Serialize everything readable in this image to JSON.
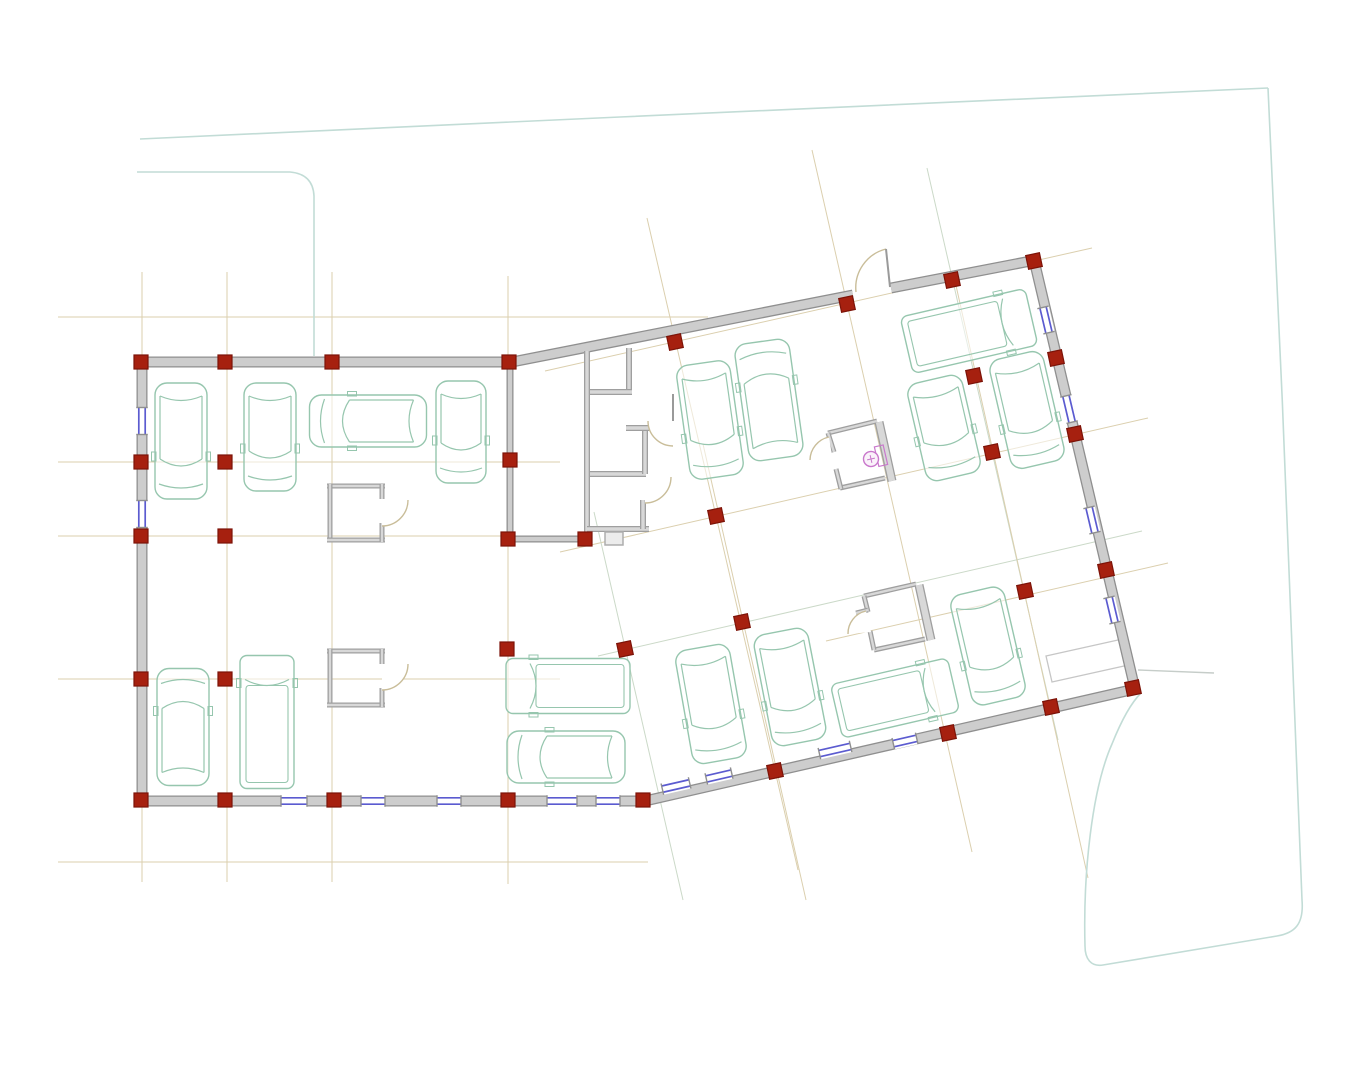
{
  "canvas": {
    "width": 1365,
    "height": 1080,
    "background": "#ffffff"
  },
  "palette": {
    "wall_edge": "#8f8f8f",
    "wall_fill": "#cdcdcd",
    "thin_edge": "#9f9f9f",
    "thin_fill": "#d8d8d8",
    "column_fill": "#a6200f",
    "column_edge": "#7c1308",
    "window_glass": "#5b5bd0",
    "car_outline": "#96c6ae",
    "door_arc": "#c9bd99",
    "leaf_gray": "#9a9a9a",
    "grid_tan": "#dbcfae",
    "grid_sage": "#cbd9c8",
    "site_teal": "#c2dcd6",
    "site_gray": "#c6cdc9",
    "toilet_pink": "#c978cc",
    "misc_gray": "#c6c6c6",
    "tab_edge": "#adadad",
    "tab_fill": "#ececec"
  },
  "grid": {
    "ortho": [
      {
        "x1": 142,
        "y1": 272,
        "x2": 142,
        "y2": 882,
        "c": "t"
      },
      {
        "x1": 227,
        "y1": 272,
        "x2": 227,
        "y2": 882,
        "c": "t"
      },
      {
        "x1": 332,
        "y1": 272,
        "x2": 332,
        "y2": 882,
        "c": "t"
      },
      {
        "x1": 508,
        "y1": 276,
        "x2": 508,
        "y2": 884,
        "c": "t"
      },
      {
        "x1": 58,
        "y1": 317,
        "x2": 708,
        "y2": 317,
        "c": "t"
      },
      {
        "x1": 58,
        "y1": 462,
        "x2": 560,
        "y2": 462,
        "c": "t"
      },
      {
        "x1": 58,
        "y1": 536,
        "x2": 560,
        "y2": 536,
        "c": "t"
      },
      {
        "x1": 58,
        "y1": 679,
        "x2": 560,
        "y2": 679,
        "c": "t"
      },
      {
        "x1": 58,
        "y1": 862,
        "x2": 648,
        "y2": 862,
        "c": "t"
      }
    ],
    "tilted": [
      {
        "x1": 545,
        "y1": 371,
        "x2": 1092,
        "y2": 248,
        "c": "t"
      },
      {
        "x1": 560,
        "y1": 552,
        "x2": 1148,
        "y2": 418,
        "c": "t"
      },
      {
        "x1": 598,
        "y1": 656,
        "x2": 1142,
        "y2": 531,
        "c": "s"
      },
      {
        "x1": 826,
        "y1": 641,
        "x2": 1168,
        "y2": 563,
        "c": "t"
      },
      {
        "x1": 647,
        "y1": 218,
        "x2": 798,
        "y2": 870,
        "c": "t"
      },
      {
        "x1": 812,
        "y1": 150,
        "x2": 972,
        "y2": 852,
        "c": "t"
      },
      {
        "x1": 927,
        "y1": 168,
        "x2": 1058,
        "y2": 740,
        "c": "s"
      },
      {
        "x1": 594,
        "y1": 512,
        "x2": 683,
        "y2": 900,
        "c": "s"
      },
      {
        "x1": 703,
        "y1": 444,
        "x2": 806,
        "y2": 900,
        "c": "t"
      },
      {
        "x1": 953,
        "y1": 272,
        "x2": 1088,
        "y2": 878,
        "c": "t"
      }
    ]
  },
  "site": {
    "teal_paths": [
      "M 140 139 L 620 117 L 1268 88",
      "M 137 172 L 290 172 Q 313 174 314 196 L 314 356",
      "M 1268 88 C 1281 350 1295 705 1302 900 C 1304 924 1295 933 1277 936 L 1103 965 C 1091 967 1085 959 1085 946 C 1083 873 1092 789 1112 744 C 1122 719 1132 702 1141 693"
    ],
    "gray_line": "M 1138 670 L 1214 673",
    "pad_quad": "M 1046 656 L 1127 638 L 1133 664 L 1052 682 Z"
  },
  "walls": {
    "outer": [
      {
        "x1": 137,
        "y1": 362,
        "x2": 512,
        "y2": 362,
        "w": 11
      },
      {
        "x1": 512,
        "y1": 362,
        "x2": 853,
        "y2": 295,
        "w": 11
      },
      {
        "x1": 891,
        "y1": 288,
        "x2": 1036,
        "y2": 260,
        "w": 11
      },
      {
        "x1": 1034,
        "y1": 260,
        "x2": 1135,
        "y2": 689,
        "w": 11
      },
      {
        "x1": 1135,
        "y1": 689,
        "x2": 645,
        "y2": 801,
        "w": 11
      },
      {
        "x1": 645,
        "y1": 801,
        "x2": 137,
        "y2": 801,
        "w": 11
      },
      {
        "x1": 142,
        "y1": 362,
        "x2": 142,
        "y2": 801,
        "w": 11
      }
    ],
    "interior": [
      {
        "x1": 510,
        "y1": 357,
        "x2": 510,
        "y2": 543,
        "w": 7
      },
      {
        "x1": 513,
        "y1": 539,
        "x2": 592,
        "y2": 539,
        "w": 7
      }
    ],
    "core": [
      {
        "x1": 587,
        "y1": 351,
        "x2": 587,
        "y2": 532,
        "w": 6
      },
      {
        "x1": 587,
        "y1": 529,
        "x2": 649,
        "y2": 529,
        "w": 6
      },
      {
        "x1": 629,
        "y1": 348,
        "x2": 629,
        "y2": 392,
        "w": 6
      },
      {
        "x1": 590,
        "y1": 392,
        "x2": 632,
        "y2": 392,
        "w": 6
      },
      {
        "x1": 590,
        "y1": 474,
        "x2": 646,
        "y2": 474,
        "w": 6
      },
      {
        "x1": 645,
        "y1": 429,
        "x2": 645,
        "y2": 474,
        "w": 6
      },
      {
        "x1": 626,
        "y1": 428,
        "x2": 654,
        "y2": 428,
        "w": 6
      },
      {
        "x1": 643,
        "y1": 500,
        "x2": 643,
        "y2": 529,
        "w": 6
      }
    ],
    "rooms": [
      {
        "x1": 327,
        "y1": 486,
        "x2": 385,
        "y2": 486,
        "w": 5
      },
      {
        "x1": 330,
        "y1": 484,
        "x2": 330,
        "y2": 542,
        "w": 5
      },
      {
        "x1": 327,
        "y1": 540,
        "x2": 385,
        "y2": 540,
        "w": 5
      },
      {
        "x1": 382,
        "y1": 484,
        "x2": 382,
        "y2": 499,
        "w": 5
      },
      {
        "x1": 382,
        "y1": 523,
        "x2": 382,
        "y2": 542,
        "w": 5
      },
      {
        "x1": 327,
        "y1": 651,
        "x2": 385,
        "y2": 651,
        "w": 5
      },
      {
        "x1": 330,
        "y1": 649,
        "x2": 330,
        "y2": 707,
        "w": 5
      },
      {
        "x1": 327,
        "y1": 705,
        "x2": 385,
        "y2": 705,
        "w": 5
      },
      {
        "x1": 382,
        "y1": 649,
        "x2": 382,
        "y2": 664,
        "w": 5
      },
      {
        "x1": 382,
        "y1": 688,
        "x2": 382,
        "y2": 707,
        "w": 5
      },
      {
        "x1": 828,
        "y1": 433,
        "x2": 877,
        "y2": 421,
        "w": 5
      },
      {
        "x1": 840,
        "y1": 488,
        "x2": 885,
        "y2": 478,
        "w": 5
      },
      {
        "x1": 828,
        "y1": 433,
        "x2": 834,
        "y2": 452,
        "w": 5
      },
      {
        "x1": 836,
        "y1": 469,
        "x2": 841,
        "y2": 489,
        "w": 5
      },
      {
        "x1": 879,
        "y1": 422,
        "x2": 892,
        "y2": 481,
        "w": 9
      },
      {
        "x1": 864,
        "y1": 596,
        "x2": 916,
        "y2": 584,
        "w": 5
      },
      {
        "x1": 874,
        "y1": 650,
        "x2": 925,
        "y2": 639,
        "w": 5
      },
      {
        "x1": 864,
        "y1": 596,
        "x2": 868,
        "y2": 612,
        "w": 5
      },
      {
        "x1": 856,
        "y1": 613,
        "x2": 868,
        "y2": 610,
        "w": 5
      },
      {
        "x1": 870,
        "y1": 631,
        "x2": 874,
        "y2": 650,
        "w": 5
      },
      {
        "x1": 919,
        "y1": 585,
        "x2": 931,
        "y2": 640,
        "w": 9
      }
    ]
  },
  "windows": [
    {
      "x": 142,
      "y": 421,
      "a": 90,
      "len": 27
    },
    {
      "x": 142,
      "y": 514,
      "a": 90,
      "len": 27
    },
    {
      "x": 294,
      "y": 801,
      "a": 0,
      "len": 26
    },
    {
      "x": 373,
      "y": 801,
      "a": 0,
      "len": 24
    },
    {
      "x": 449,
      "y": 801,
      "a": 0,
      "len": 24
    },
    {
      "x": 562,
      "y": 801,
      "a": 0,
      "len": 30
    },
    {
      "x": 608,
      "y": 801,
      "a": 0,
      "len": 24
    },
    {
      "x": 676,
      "y": 786,
      "a": -12.9,
      "len": 28
    },
    {
      "x": 719,
      "y": 776,
      "a": -12.9,
      "len": 26
    },
    {
      "x": 835,
      "y": 750,
      "a": -12.9,
      "len": 32
    },
    {
      "x": 905,
      "y": 741,
      "a": -12.9,
      "len": 24
    },
    {
      "x": 1046,
      "y": 320,
      "a": 76.7,
      "len": 26
    },
    {
      "x": 1069,
      "y": 409,
      "a": 76.7,
      "len": 27
    },
    {
      "x": 1092,
      "y": 520,
      "a": 76.7,
      "len": 26
    },
    {
      "x": 1112,
      "y": 610,
      "a": 76.7,
      "len": 26
    }
  ],
  "columns": [
    {
      "x": 141,
      "y": 362,
      "a": 0
    },
    {
      "x": 225,
      "y": 362,
      "a": 0
    },
    {
      "x": 332,
      "y": 362,
      "a": 0
    },
    {
      "x": 509,
      "y": 362,
      "a": 0
    },
    {
      "x": 675,
      "y": 342,
      "a": -12
    },
    {
      "x": 847,
      "y": 304,
      "a": -12
    },
    {
      "x": 952,
      "y": 280,
      "a": -12
    },
    {
      "x": 1034,
      "y": 261,
      "a": -12
    },
    {
      "x": 141,
      "y": 462,
      "a": 0
    },
    {
      "x": 141,
      "y": 536,
      "a": 0
    },
    {
      "x": 141,
      "y": 679,
      "a": 0
    },
    {
      "x": 141,
      "y": 800,
      "a": 0
    },
    {
      "x": 225,
      "y": 800,
      "a": 0
    },
    {
      "x": 334,
      "y": 800,
      "a": 0
    },
    {
      "x": 508,
      "y": 800,
      "a": 0
    },
    {
      "x": 643,
      "y": 800,
      "a": 0
    },
    {
      "x": 775,
      "y": 771,
      "a": -12
    },
    {
      "x": 948,
      "y": 733,
      "a": -12
    },
    {
      "x": 1051,
      "y": 707,
      "a": -12
    },
    {
      "x": 1133,
      "y": 688,
      "a": -12
    },
    {
      "x": 1056,
      "y": 358,
      "a": -12
    },
    {
      "x": 1075,
      "y": 434,
      "a": -12
    },
    {
      "x": 1106,
      "y": 570,
      "a": -12
    },
    {
      "x": 225,
      "y": 462,
      "a": 0
    },
    {
      "x": 225,
      "y": 536,
      "a": 0
    },
    {
      "x": 225,
      "y": 679,
      "a": 0
    },
    {
      "x": 510,
      "y": 460,
      "a": 0
    },
    {
      "x": 508,
      "y": 539,
      "a": 0
    },
    {
      "x": 585,
      "y": 539,
      "a": 0
    },
    {
      "x": 716,
      "y": 516,
      "a": -12
    },
    {
      "x": 974,
      "y": 376,
      "a": -12
    },
    {
      "x": 992,
      "y": 452,
      "a": -12
    },
    {
      "x": 1025,
      "y": 591,
      "a": -12
    },
    {
      "x": 742,
      "y": 622,
      "a": -12
    },
    {
      "x": 625,
      "y": 649,
      "a": -12
    },
    {
      "x": 507,
      "y": 649,
      "a": 0
    }
  ],
  "doors": [
    {
      "wedge": "M 856 292 A 40 40 0 0 1 886 249 L 890 287 Z",
      "arc": "M 856 292 A 40 40 0 0 1 886 249",
      "leaf": "M 886 249 L 890 287"
    },
    {
      "wedge": "M 382 500 L 408 500 A 26 26 0 0 1 382 526 Z",
      "arc": "M 408 500 A 26 26 0 0 1 382 526",
      "leaf": ""
    },
    {
      "wedge": "M 382 664 L 408 664 A 26 26 0 0 1 382 690 Z",
      "arc": "M 408 664 A 26 26 0 0 1 382 690",
      "leaf": ""
    },
    {
      "wedge": "M 834 468 L 829 437 A 24 24 0 0 0 810 460 Z",
      "arc": "M 829 437 A 24 24 0 0 0 810 460",
      "leaf": ""
    },
    {
      "wedge": "M 871 632 L 866 611 A 23 23 0 0 0 848 634 Z",
      "arc": "M 866 611 A 23 23 0 0 0 848 634",
      "leaf": ""
    },
    {
      "wedge": "M 673 421 L 648 421 A 25 25 0 0 0 673 446 Z",
      "arc": "M 648 421 A 25 25 0 0 0 673 446",
      "leaf": "M 673 394 L 673 421"
    },
    {
      "wedge": "M 645 477 L 671 477 A 26 26 0 0 1 645 503 Z",
      "arc": "M 671 477 A 26 26 0 0 1 645 503",
      "leaf": ""
    }
  ],
  "cars": [
    {
      "type": "car",
      "cx": 181,
      "cy": 441,
      "w": 52,
      "l": 116,
      "angle": 0
    },
    {
      "type": "car",
      "cx": 270,
      "cy": 437,
      "w": 52,
      "l": 108,
      "angle": 0
    },
    {
      "type": "car",
      "cx": 368,
      "cy": 421,
      "w": 52,
      "l": 117,
      "angle": 90
    },
    {
      "type": "car",
      "cx": 461,
      "cy": 432,
      "w": 50,
      "l": 102,
      "angle": 0
    },
    {
      "type": "car",
      "cx": 710,
      "cy": 420,
      "w": 54,
      "l": 115,
      "angle": -8
    },
    {
      "type": "car",
      "cx": 769,
      "cy": 400,
      "w": 55,
      "l": 118,
      "angle": 172
    },
    {
      "type": "van",
      "cx": 969,
      "cy": 331,
      "w": 58,
      "l": 128,
      "angle": -103
    },
    {
      "type": "car",
      "cx": 944,
      "cy": 428,
      "w": 56,
      "l": 100,
      "angle": -13
    },
    {
      "type": "car",
      "cx": 1027,
      "cy": 410,
      "w": 55,
      "l": 112,
      "angle": -13
    },
    {
      "type": "van",
      "cx": 568,
      "cy": 686,
      "w": 55,
      "l": 124,
      "angle": 90
    },
    {
      "type": "car",
      "cx": 566,
      "cy": 757,
      "w": 52,
      "l": 118,
      "angle": 90
    },
    {
      "type": "car",
      "cx": 711,
      "cy": 704,
      "w": 55,
      "l": 115,
      "angle": -10
    },
    {
      "type": "car",
      "cx": 790,
      "cy": 687,
      "w": 55,
      "l": 113,
      "angle": -11
    },
    {
      "type": "van",
      "cx": 895,
      "cy": 698,
      "w": 55,
      "l": 120,
      "angle": -103
    },
    {
      "type": "car",
      "cx": 988,
      "cy": 646,
      "w": 55,
      "l": 113,
      "angle": -13
    },
    {
      "type": "car",
      "cx": 183,
      "cy": 727,
      "w": 52,
      "l": 117,
      "angle": 180
    },
    {
      "type": "van",
      "cx": 267,
      "cy": 722,
      "w": 54,
      "l": 133,
      "angle": 180
    }
  ],
  "fixtures": {
    "toilet": {
      "cx": 871,
      "cy": 459,
      "r": 7.5,
      "angle": -13,
      "tank": {
        "x": 877,
        "y": 448,
        "w": 9,
        "h": 20
      }
    },
    "tab": {
      "x": 605,
      "y": 532,
      "w": 18,
      "h": 13
    }
  }
}
